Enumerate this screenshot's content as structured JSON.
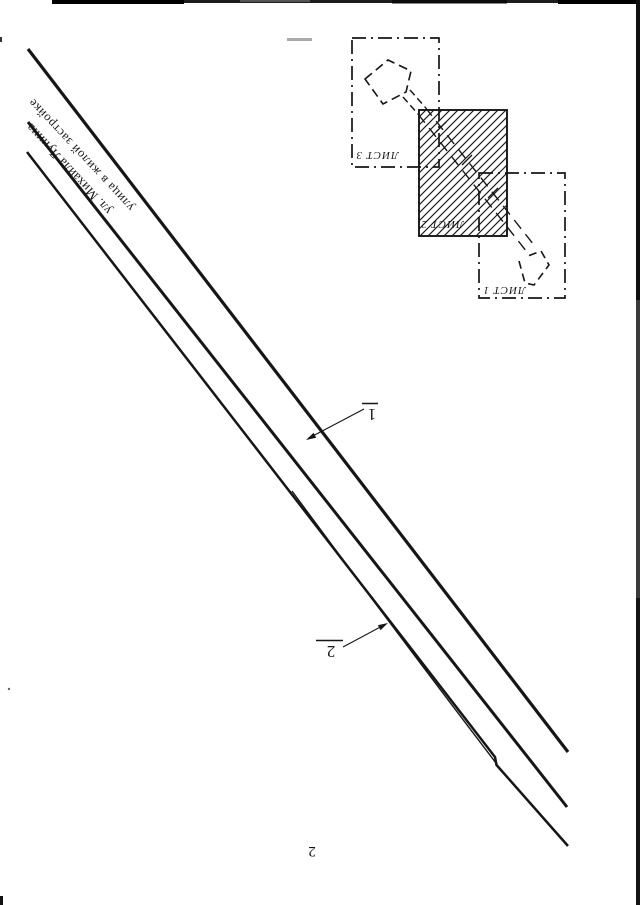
{
  "page": {
    "page_number": "2",
    "paper_color": "#ffffff",
    "ink_color": "#161616"
  },
  "street": {
    "name": "ул. Михаила Лунина",
    "description": "улица в жилой застройке"
  },
  "callouts": [
    {
      "label": "1"
    },
    {
      "label": "2"
    }
  ],
  "sheet_key": {
    "sheets": [
      {
        "label": "ЛИСТ 1"
      },
      {
        "label": "ЛИСТ 2"
      },
      {
        "label": "ЛИСТ 3"
      }
    ]
  }
}
